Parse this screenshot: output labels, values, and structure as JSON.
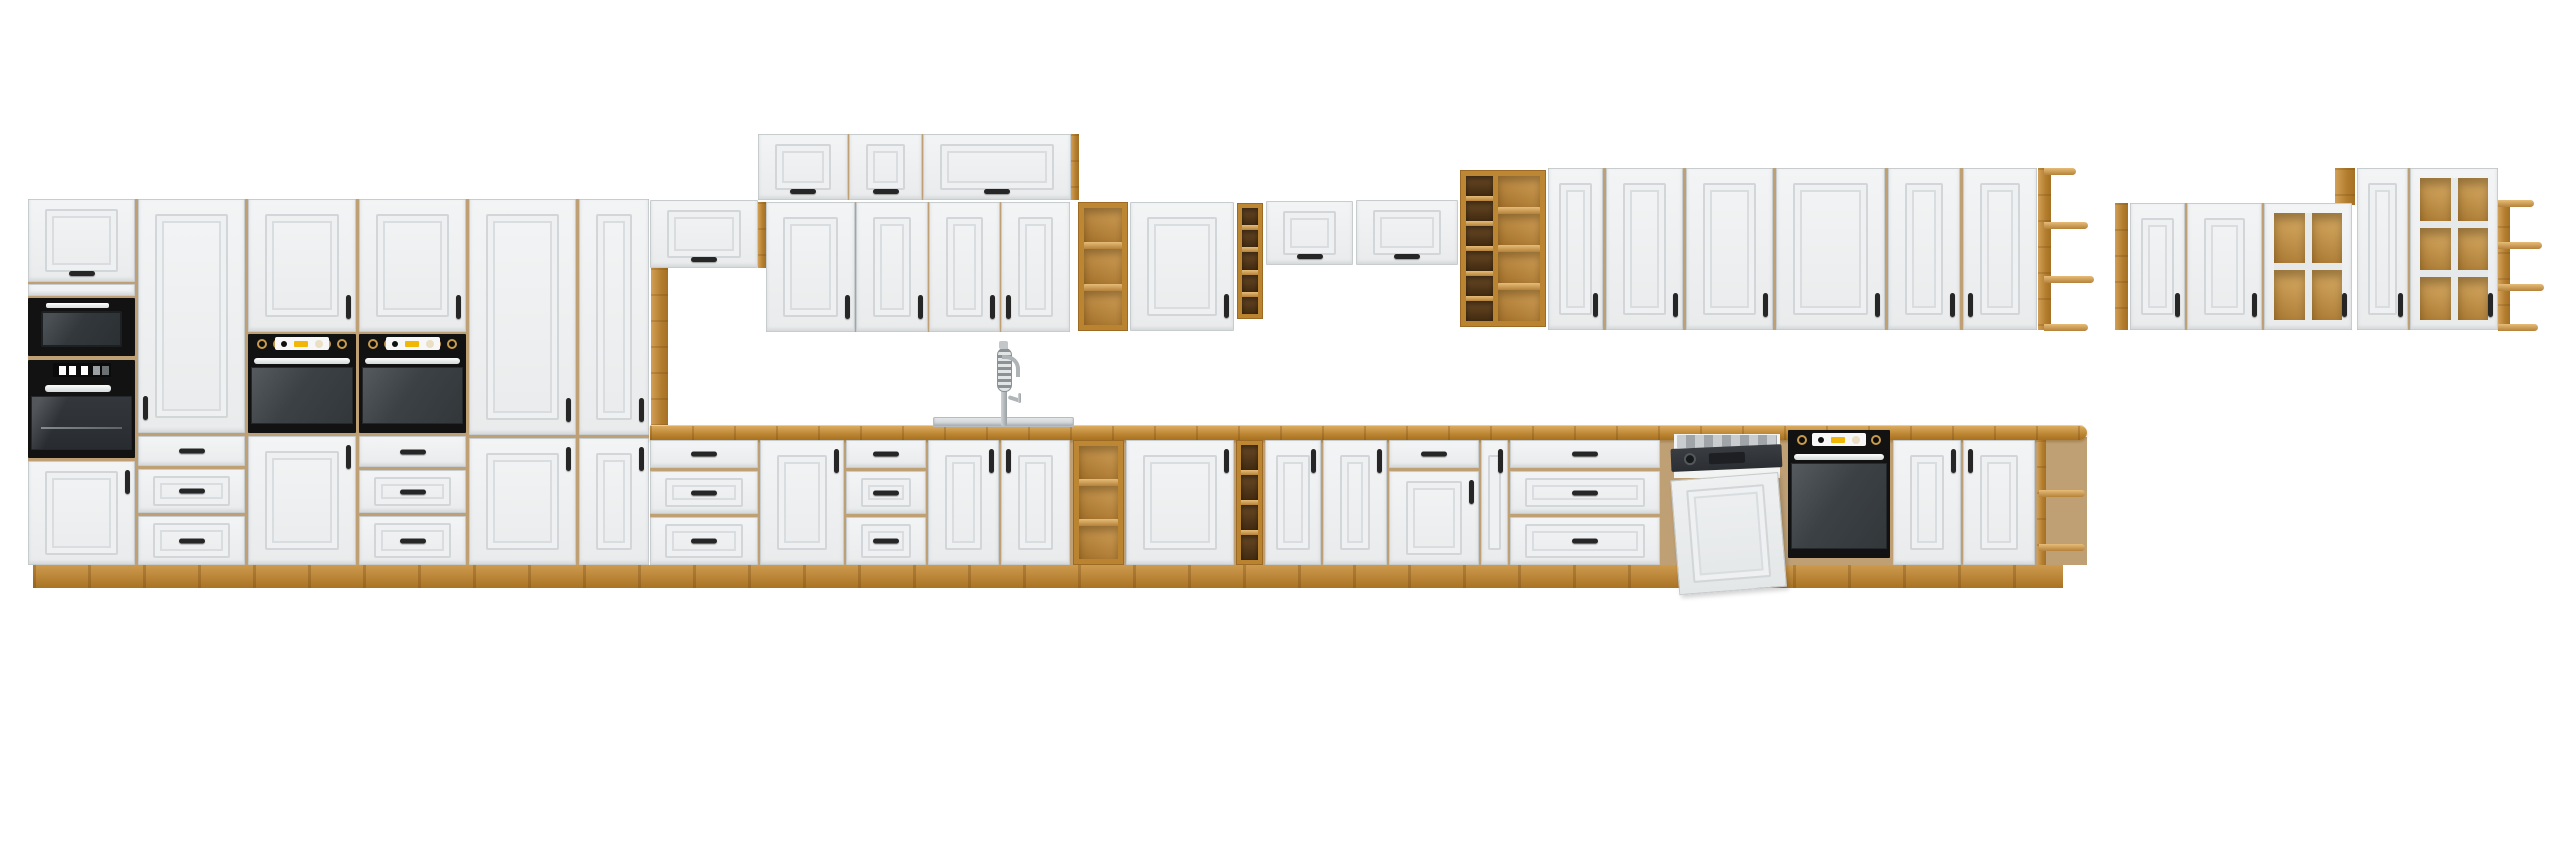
{
  "scene": {
    "description": "Product render of a white classic-style kitchen furniture set with oak wood countertop, plinth and open shelving, black built-in appliances (microwave, three ovens, dishwasher with door ajar), a sink with tall spring faucet, and a separate floating group of wall cabinets with oak-backed glass mullion doors, all on a plain white background.",
    "width": 2560,
    "height": 848,
    "colors": {
      "background": "#ffffff",
      "cabinet_front": "#eef0f1",
      "panel_line": "#d2d6d8",
      "oak": "#b9832f",
      "oak_light": "#dcab5f",
      "oak_dark": "#a06c22",
      "cubby_interior": "#4a3113",
      "appliance_black": "#121212",
      "oven_door_gray": "#3c4145",
      "handle_black": "#262626",
      "handle_silver": "#e9ebec",
      "knob_gold": "#c79b4c",
      "display_yellow": "#f2b705",
      "display_white": "#f7f7f7",
      "sink_steel": "#d6d9da",
      "faucet_chrome": "#aeb3b6"
    },
    "modules": [
      {
        "t": "backer",
        "x": 28,
        "y": 199,
        "w": 621,
        "h": 366
      },
      {
        "t": "backer",
        "x": 758,
        "y": 134,
        "w": 320,
        "h": 66
      },
      {
        "t": "backer",
        "x": 766,
        "y": 202,
        "w": 304,
        "h": 130
      },
      {
        "t": "backer",
        "x": 650,
        "y": 437,
        "w": 1437,
        "h": 128
      },
      {
        "t": "backer",
        "x": 1548,
        "y": 168,
        "w": 489,
        "h": 162
      },
      {
        "t": "backer",
        "x": 2130,
        "y": 203,
        "w": 222,
        "h": 127
      },
      {
        "t": "backer",
        "x": 2357,
        "y": 168,
        "w": 141,
        "h": 162
      },
      {
        "t": "plinth",
        "x": 33,
        "y": 565,
        "w": 2030,
        "h": 23
      },
      {
        "t": "flip",
        "x": 28,
        "y": 199,
        "w": 107,
        "h": 83,
        "o": {
          "h": "bc"
        }
      },
      {
        "t": "band",
        "x": 28,
        "y": 284,
        "w": 107,
        "h": 12
      },
      {
        "t": "microwave",
        "x": 28,
        "y": 298,
        "w": 107,
        "h": 58
      },
      {
        "t": "ovenB",
        "x": 28,
        "y": 360,
        "w": 107,
        "h": 98
      },
      {
        "t": "door",
        "x": 28,
        "y": 461,
        "w": 107,
        "h": 104,
        "o": {
          "h": "tr"
        }
      },
      {
        "t": "door",
        "x": 138,
        "y": 199,
        "w": 107,
        "h": 234,
        "o": {
          "h": "bl"
        }
      },
      {
        "t": "drawer",
        "x": 138,
        "y": 436,
        "w": 107,
        "h": 30,
        "o": {
          "h": "cc"
        }
      },
      {
        "t": "drawerp",
        "x": 138,
        "y": 469,
        "w": 107,
        "h": 44,
        "o": {
          "h": "cc"
        }
      },
      {
        "t": "drawerp",
        "x": 138,
        "y": 516,
        "w": 107,
        "h": 49,
        "o": {
          "h": "cc"
        }
      },
      {
        "t": "door",
        "x": 248,
        "y": 199,
        "w": 108,
        "h": 133,
        "o": {
          "h": "br"
        }
      },
      {
        "t": "ovenA",
        "x": 248,
        "y": 334,
        "w": 108,
        "h": 99
      },
      {
        "t": "door",
        "x": 248,
        "y": 436,
        "w": 108,
        "h": 129,
        "o": {
          "h": "tr"
        }
      },
      {
        "t": "door",
        "x": 359,
        "y": 199,
        "w": 107,
        "h": 133,
        "o": {
          "h": "br"
        }
      },
      {
        "t": "ovenA",
        "x": 359,
        "y": 334,
        "w": 107,
        "h": 99
      },
      {
        "t": "drawer",
        "x": 359,
        "y": 436,
        "w": 107,
        "h": 31,
        "o": {
          "h": "cc"
        }
      },
      {
        "t": "drawerp",
        "x": 359,
        "y": 470,
        "w": 107,
        "h": 43,
        "o": {
          "h": "cc"
        }
      },
      {
        "t": "drawerp",
        "x": 359,
        "y": 516,
        "w": 107,
        "h": 49,
        "o": {
          "h": "cc"
        }
      },
      {
        "t": "door",
        "x": 469,
        "y": 199,
        "w": 107,
        "h": 236,
        "o": {
          "h": "br"
        }
      },
      {
        "t": "door",
        "x": 469,
        "y": 438,
        "w": 107,
        "h": 127,
        "o": {
          "h": "tr"
        }
      },
      {
        "t": "door",
        "x": 579,
        "y": 199,
        "w": 70,
        "h": 236,
        "o": {
          "h": "br"
        }
      },
      {
        "t": "door",
        "x": 579,
        "y": 438,
        "w": 70,
        "h": 127,
        "o": {
          "h": "tr"
        }
      },
      {
        "t": "flip",
        "x": 650,
        "y": 200,
        "w": 108,
        "h": 68,
        "o": {
          "h": "bc"
        }
      },
      {
        "t": "oak",
        "x": 651,
        "y": 268,
        "w": 17,
        "h": 158
      },
      {
        "t": "flip",
        "x": 758,
        "y": 134,
        "w": 90,
        "h": 66,
        "o": {
          "h": "bc"
        }
      },
      {
        "t": "flip",
        "x": 849,
        "y": 134,
        "w": 73,
        "h": 66,
        "o": {
          "h": "bc"
        }
      },
      {
        "t": "flip",
        "x": 923,
        "y": 134,
        "w": 148,
        "h": 66,
        "o": {
          "h": "bc"
        }
      },
      {
        "t": "oak",
        "x": 1071,
        "y": 134,
        "w": 8,
        "h": 66
      },
      {
        "t": "oak",
        "x": 758,
        "y": 202,
        "w": 8,
        "h": 66
      },
      {
        "t": "door",
        "x": 766,
        "y": 202,
        "w": 89,
        "h": 130,
        "o": {
          "h": "br"
        }
      },
      {
        "t": "door",
        "x": 856,
        "y": 202,
        "w": 72,
        "h": 130,
        "o": {
          "h": "br"
        }
      },
      {
        "t": "door",
        "x": 929,
        "y": 202,
        "w": 71,
        "h": 130,
        "o": {
          "h": "br"
        }
      },
      {
        "t": "door",
        "x": 1001,
        "y": 202,
        "w": 69,
        "h": 130,
        "o": {
          "h": "bl"
        }
      },
      {
        "t": "shelves",
        "x": 1078,
        "y": 202,
        "w": 50,
        "h": 129,
        "o": {
          "n": 3
        }
      },
      {
        "t": "door",
        "x": 1130,
        "y": 202,
        "w": 104,
        "h": 129,
        "o": {
          "h": "br"
        }
      },
      {
        "t": "cubbies",
        "x": 1237,
        "y": 203,
        "w": 26,
        "h": 116,
        "o": {
          "n": 5
        }
      },
      {
        "t": "flip",
        "x": 1266,
        "y": 201,
        "w": 87,
        "h": 64,
        "o": {
          "h": "bc"
        }
      },
      {
        "t": "flip",
        "x": 1356,
        "y": 200,
        "w": 102,
        "h": 65,
        "o": {
          "h": "bc"
        }
      },
      {
        "t": "winerack",
        "x": 1460,
        "y": 170,
        "w": 86,
        "h": 157
      },
      {
        "t": "door",
        "x": 1548,
        "y": 168,
        "w": 55,
        "h": 162,
        "o": {
          "h": "br"
        }
      },
      {
        "t": "door",
        "x": 1606,
        "y": 168,
        "w": 77,
        "h": 162,
        "o": {
          "h": "br"
        }
      },
      {
        "t": "door",
        "x": 1686,
        "y": 168,
        "w": 87,
        "h": 162,
        "o": {
          "h": "br"
        }
      },
      {
        "t": "door",
        "x": 1776,
        "y": 168,
        "w": 109,
        "h": 162,
        "o": {
          "h": "br"
        }
      },
      {
        "t": "door",
        "x": 1888,
        "y": 168,
        "w": 72,
        "h": 162,
        "o": {
          "h": "br"
        }
      },
      {
        "t": "door",
        "x": 1963,
        "y": 168,
        "w": 74,
        "h": 162,
        "o": {
          "h": "bl"
        }
      },
      {
        "t": "endshelfL",
        "x": 2038,
        "y": 168,
        "w": 50,
        "h": 162
      },
      {
        "t": "oak",
        "x": 2115,
        "y": 203,
        "w": 13,
        "h": 127
      },
      {
        "t": "door",
        "x": 2130,
        "y": 203,
        "w": 55,
        "h": 127,
        "o": {
          "h": "br"
        }
      },
      {
        "t": "door",
        "x": 2187,
        "y": 203,
        "w": 75,
        "h": 127,
        "o": {
          "h": "br"
        }
      },
      {
        "t": "oak",
        "x": 2335,
        "y": 168,
        "w": 20,
        "h": 37
      },
      {
        "t": "glass",
        "x": 2264,
        "y": 203,
        "w": 88,
        "h": 127,
        "o": {
          "cols": 2,
          "rows": 2,
          "h": "br"
        }
      },
      {
        "t": "door",
        "x": 2357,
        "y": 168,
        "w": 51,
        "h": 162,
        "o": {
          "h": "br"
        }
      },
      {
        "t": "glass",
        "x": 2410,
        "y": 168,
        "w": 88,
        "h": 162,
        "o": {
          "cols": 2,
          "rows": 3,
          "h": "br"
        }
      },
      {
        "t": "endshelfR",
        "x": 2498,
        "y": 200,
        "w": 46,
        "h": 130
      },
      {
        "t": "counter",
        "x": 650,
        "y": 425,
        "w": 1437,
        "h": 15
      },
      {
        "t": "drawer",
        "x": 650,
        "y": 440,
        "w": 108,
        "h": 28,
        "o": {
          "h": "cc"
        }
      },
      {
        "t": "drawerp",
        "x": 650,
        "y": 471,
        "w": 108,
        "h": 43,
        "o": {
          "h": "cc"
        }
      },
      {
        "t": "drawerp",
        "x": 650,
        "y": 517,
        "w": 108,
        "h": 48,
        "o": {
          "h": "cc"
        }
      },
      {
        "t": "door",
        "x": 760,
        "y": 440,
        "w": 84,
        "h": 125,
        "o": {
          "h": "tr"
        }
      },
      {
        "t": "drawer",
        "x": 846,
        "y": 440,
        "w": 80,
        "h": 28,
        "o": {
          "h": "cc"
        }
      },
      {
        "t": "drawerp",
        "x": 846,
        "y": 471,
        "w": 80,
        "h": 43,
        "o": {
          "h": "cc"
        }
      },
      {
        "t": "drawerp",
        "x": 846,
        "y": 517,
        "w": 80,
        "h": 48,
        "o": {
          "h": "cc"
        }
      },
      {
        "t": "door",
        "x": 928,
        "y": 440,
        "w": 71,
        "h": 125,
        "o": {
          "h": "tr"
        }
      },
      {
        "t": "door",
        "x": 1001,
        "y": 440,
        "w": 69,
        "h": 125,
        "o": {
          "h": "tl"
        }
      },
      {
        "t": "shelves",
        "x": 1073,
        "y": 440,
        "w": 51,
        "h": 125,
        "o": {
          "n": 3
        }
      },
      {
        "t": "door",
        "x": 1126,
        "y": 440,
        "w": 108,
        "h": 125,
        "o": {
          "h": "tr"
        }
      },
      {
        "t": "cubbies",
        "x": 1236,
        "y": 440,
        "w": 27,
        "h": 125,
        "o": {
          "n": 4
        }
      },
      {
        "t": "door",
        "x": 1265,
        "y": 440,
        "w": 56,
        "h": 125,
        "o": {
          "h": "tr"
        }
      },
      {
        "t": "door",
        "x": 1323,
        "y": 440,
        "w": 64,
        "h": 125,
        "o": {
          "h": "tr"
        }
      },
      {
        "t": "drawer",
        "x": 1389,
        "y": 440,
        "w": 90,
        "h": 28,
        "o": {
          "h": "cc"
        }
      },
      {
        "t": "door",
        "x": 1389,
        "y": 471,
        "w": 90,
        "h": 94,
        "o": {
          "h": "tr"
        }
      },
      {
        "t": "door",
        "x": 1481,
        "y": 440,
        "w": 27,
        "h": 125,
        "o": {
          "h": "tr"
        }
      },
      {
        "t": "drawer",
        "x": 1510,
        "y": 440,
        "w": 150,
        "h": 28,
        "o": {
          "h": "cc"
        }
      },
      {
        "t": "drawerp",
        "x": 1510,
        "y": 471,
        "w": 150,
        "h": 43,
        "o": {
          "h": "cc"
        }
      },
      {
        "t": "drawerp",
        "x": 1510,
        "y": 517,
        "w": 150,
        "h": 48,
        "o": {
          "h": "cc"
        }
      },
      {
        "t": "dw",
        "x": 1668,
        "y": 430,
        "w": 120,
        "h": 150
      },
      {
        "t": "ovenA",
        "x": 1788,
        "y": 430,
        "w": 102,
        "h": 128
      },
      {
        "t": "door",
        "x": 1893,
        "y": 440,
        "w": 68,
        "h": 125,
        "o": {
          "h": "tr"
        }
      },
      {
        "t": "door",
        "x": 1963,
        "y": 440,
        "w": 72,
        "h": 125,
        "o": {
          "h": "tl"
        }
      },
      {
        "t": "endshelfB",
        "x": 2037,
        "y": 440,
        "w": 47,
        "h": 125
      },
      {
        "t": "sink",
        "x": 933,
        "y": 417,
        "w": 141,
        "h": 10
      },
      {
        "t": "faucet",
        "x": 988,
        "y": 341,
        "w": 34,
        "h": 85
      }
    ]
  }
}
